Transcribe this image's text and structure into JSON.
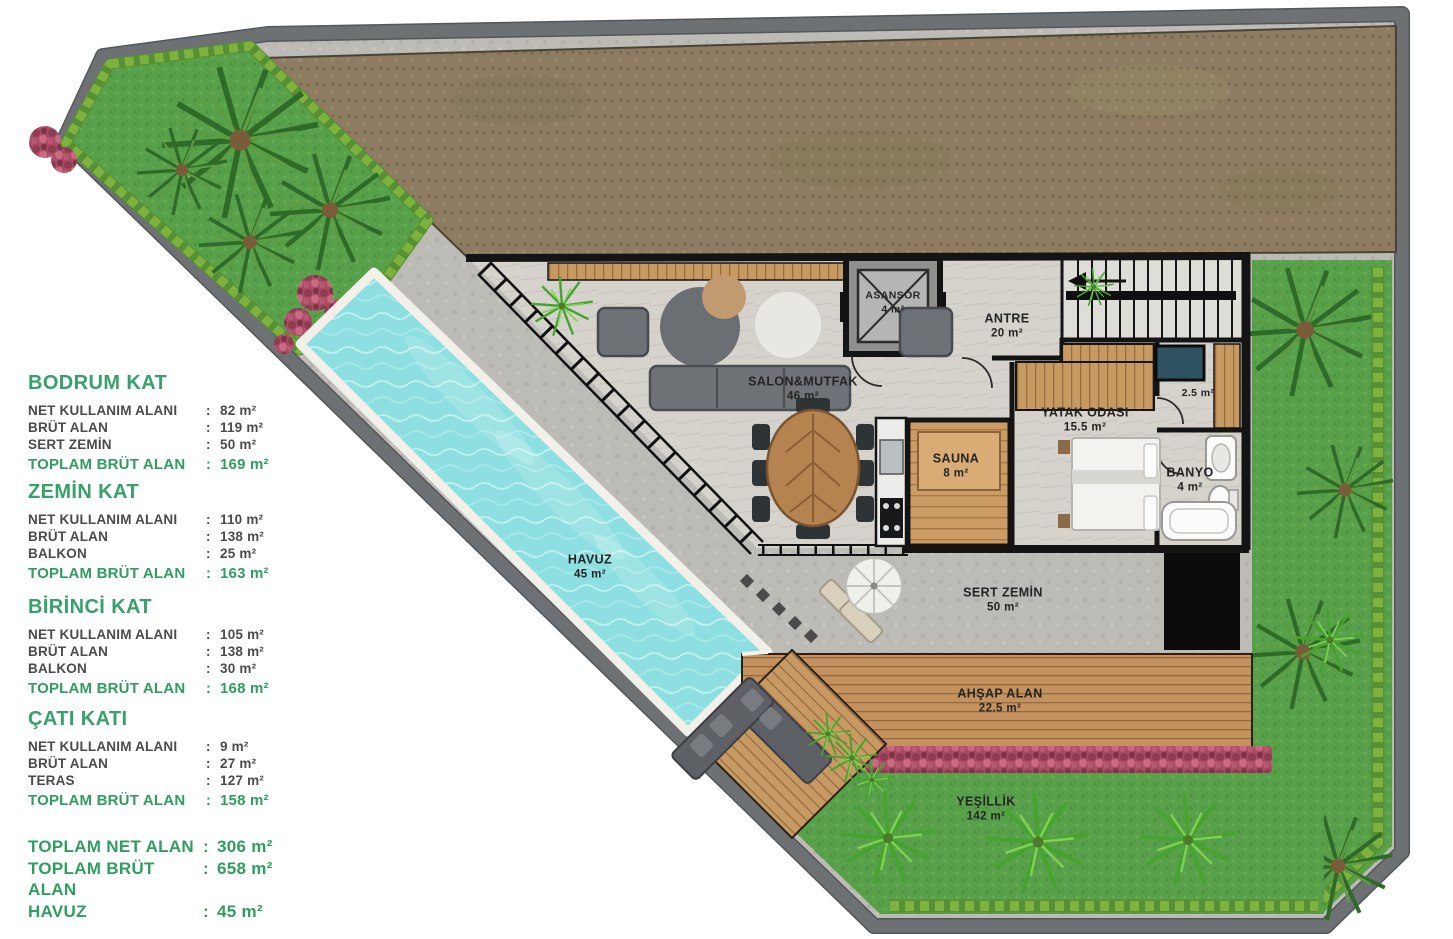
{
  "panel": {
    "colon": ":",
    "text_color": "#4b4b4b",
    "accent_green": "#2f9e5f",
    "sections": [
      {
        "title": "BODRUM KAT",
        "rows": [
          {
            "label": "NET KULLANIM ALANI",
            "value": "82 m²"
          },
          {
            "label": "BRÜT ALAN",
            "value": "119 m²"
          },
          {
            "label": "SERT ZEMİN",
            "value": "50 m²"
          }
        ],
        "total_label": "TOPLAM BRÜT ALAN",
        "total_value": "169 m²"
      },
      {
        "title": "ZEMİN KAT",
        "rows": [
          {
            "label": "NET KULLANIM ALANI",
            "value": "110 m²"
          },
          {
            "label": "BRÜT ALAN",
            "value": "138 m²"
          },
          {
            "label": "BALKON",
            "value": "25 m²"
          }
        ],
        "total_label": "TOPLAM BRÜT ALAN",
        "total_value": "163 m²"
      },
      {
        "title": "BİRİNCİ KAT",
        "rows": [
          {
            "label": "NET KULLANIM ALANI",
            "value": "105 m²"
          },
          {
            "label": "BRÜT ALAN",
            "value": "138 m²"
          },
          {
            "label": "BALKON",
            "value": "30 m²"
          }
        ],
        "total_label": "TOPLAM BRÜT ALAN",
        "total_value": "168 m²"
      },
      {
        "title": "ÇATI KATI",
        "rows": [
          {
            "label": "NET KULLANIM ALANI",
            "value": "9 m²"
          },
          {
            "label": "BRÜT ALAN",
            "value": "27 m²"
          },
          {
            "label": "TERAS",
            "value": "127 m²"
          }
        ],
        "total_label": "TOPLAM BRÜT ALAN",
        "total_value": "158 m²"
      }
    ],
    "summary": [
      {
        "label": "TOPLAM NET ALAN",
        "value": "306 m²"
      },
      {
        "label": "TOPLAM BRÜT ALAN",
        "value": "658 m²"
      },
      {
        "label": "HAVUZ",
        "value": "45 m²"
      }
    ]
  },
  "plan": {
    "rooms": {
      "asansor": {
        "name": "ASANSÖR",
        "area": "4 m²"
      },
      "antre": {
        "name": "ANTRE",
        "area": "20 m²"
      },
      "salon": {
        "name": "SALON&MUTFAK",
        "area": "46 m²"
      },
      "yatak": {
        "name": "YATAK ODASI",
        "area": "15.5 m²"
      },
      "wc": {
        "area": "2.5 m²"
      },
      "banyo": {
        "name": "BANYO",
        "area": "4 m²"
      },
      "sauna": {
        "name": "SAUNA",
        "area": "8 m²"
      }
    },
    "outdoor": {
      "havuz": {
        "name": "HAVUZ",
        "area": "45 m²"
      },
      "sert_zemin": {
        "name": "SERT ZEMİN",
        "area": "50 m²"
      },
      "ahsap_alan": {
        "name": "AHŞAP ALAN",
        "area": "22.5 m²"
      },
      "yesillik": {
        "name": "YEŞİLLİK",
        "area": "142 m²"
      }
    },
    "colors": {
      "pool": "#8ddfe1",
      "grass": "#58a04a",
      "soil": "#8d7c61",
      "wood_deck": "#c3925e",
      "wall": "#141414",
      "site_border": "#6d7174",
      "flowers": "#a94c63"
    }
  }
}
